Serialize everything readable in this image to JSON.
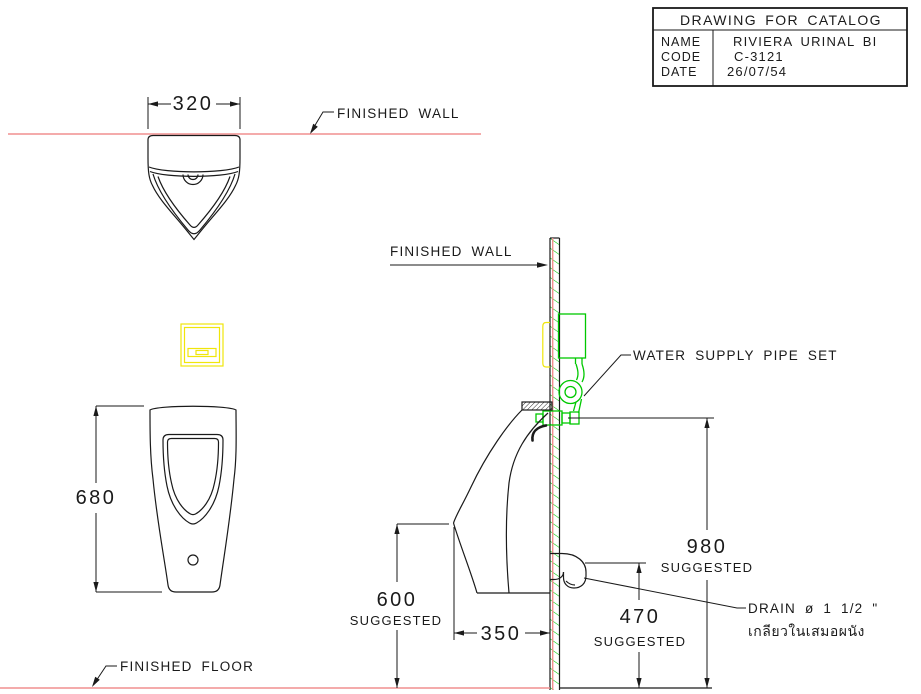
{
  "title_block": {
    "title": "DRAWING FOR CATALOG",
    "rows": [
      {
        "label": "NAME",
        "value": "RIVIERA URINAL BI"
      },
      {
        "label": "CODE",
        "value": "C-3121"
      },
      {
        "label": "DATE",
        "value": "26/07/54"
      }
    ]
  },
  "labels": {
    "finished_wall_plan": "FINISHED WALL",
    "finished_wall_side": "FINISHED WALL",
    "finished_floor": "FINISHED FLOOR",
    "water_supply_pipe_set": "WATER SUPPLY PIPE SET",
    "drain_spec": "DRAIN ø 1 1/2 \"",
    "drain_spec_thai": "เกลียวในเสมอผนัง"
  },
  "dimensions": {
    "plan_width": "320",
    "front_height": "680",
    "rim_height": "600",
    "rim_height_note": "SUGGESTED",
    "depth": "350",
    "drain_height": "470",
    "drain_height_note": "SUGGESTED",
    "supply_height": "980",
    "supply_height_note": "SUGGESTED"
  },
  "colors": {
    "finish_line": "#f08f8f",
    "drawing_line": "#1a1a1a",
    "supply_green": "#00c800",
    "sensor_yellow": "#f0e60a"
  }
}
